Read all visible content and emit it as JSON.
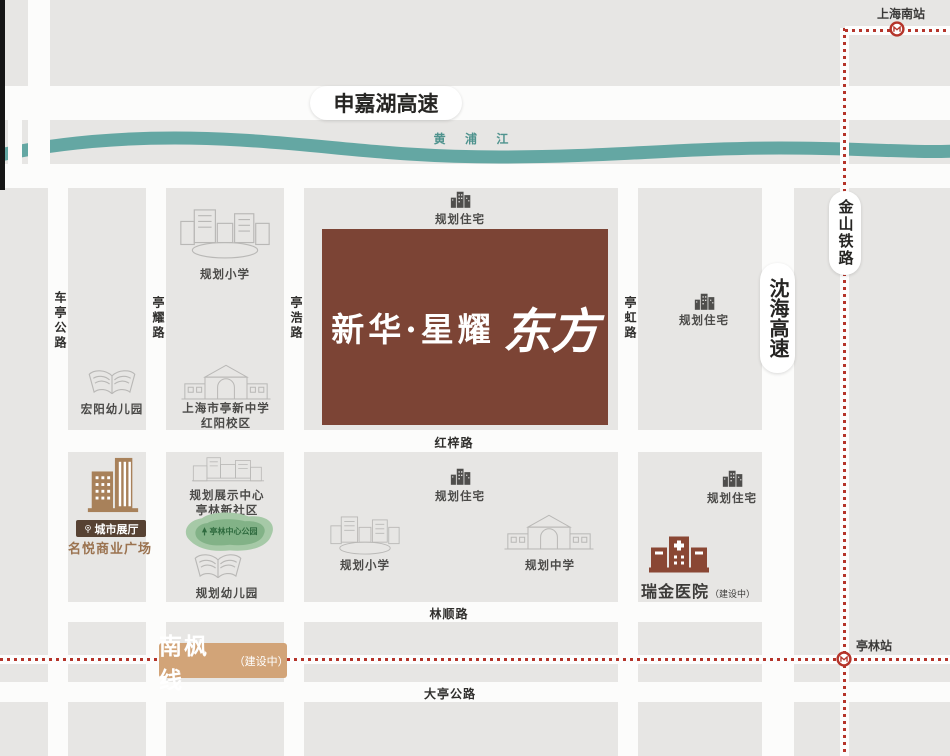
{
  "project": {
    "name_main": "新华·星耀",
    "name_accent": "东方"
  },
  "roads": {
    "shenjiahu_expwy": "申嘉湖高速",
    "shenhai_expwy": "沈海高速",
    "jinshan_railway": "金山铁路",
    "cheting_rd": "车亭公路",
    "tingyao_rd": "亭耀路",
    "tinghao_rd": "亭浩路",
    "tinghong_rd": "亭虹路",
    "hongzi_rd": "红梓路",
    "linshun_rd": "林顺路",
    "dating_rd": "大亭公路"
  },
  "river": {
    "name": "黄 浦 江"
  },
  "rail": {
    "shanghai_south_station": "上海南站",
    "tinglin_station": "亭林站",
    "nanfeng_line": "南枫线",
    "nanfeng_status": "（建设中）"
  },
  "pois": {
    "planned_residence": "规划住宅",
    "planned_primary_school": "规划小学",
    "planned_middle_school": "规划中学",
    "planned_kindergarten": "规划幼儿园",
    "hongyang_kindergarten": "宏阳幼儿园",
    "tingxin_school_line1": "上海市亭新中学",
    "tingxin_school_line2": "红阳校区",
    "exhibition_center_line1": "规划展示中心",
    "exhibition_center_line2": "亭林新社区",
    "tinglin_central_park": "亭林中心公园",
    "city_exhibition_hall": "城市展厅",
    "mingyue_plaza": "名悦商业广场",
    "ruijin_hospital": "瑞金医院",
    "ruijin_status": "（建设中）"
  },
  "colors": {
    "brand_brown": "#7c4435",
    "river_teal": "#64a7a3",
    "rail_red": "#b5342a",
    "nanfeng_tan": "#d2a478",
    "mingyue_tan": "#a8815a",
    "badge_brown": "#574233",
    "block_gray": "#e7e6e4",
    "road_white": "#fcfcfb"
  }
}
